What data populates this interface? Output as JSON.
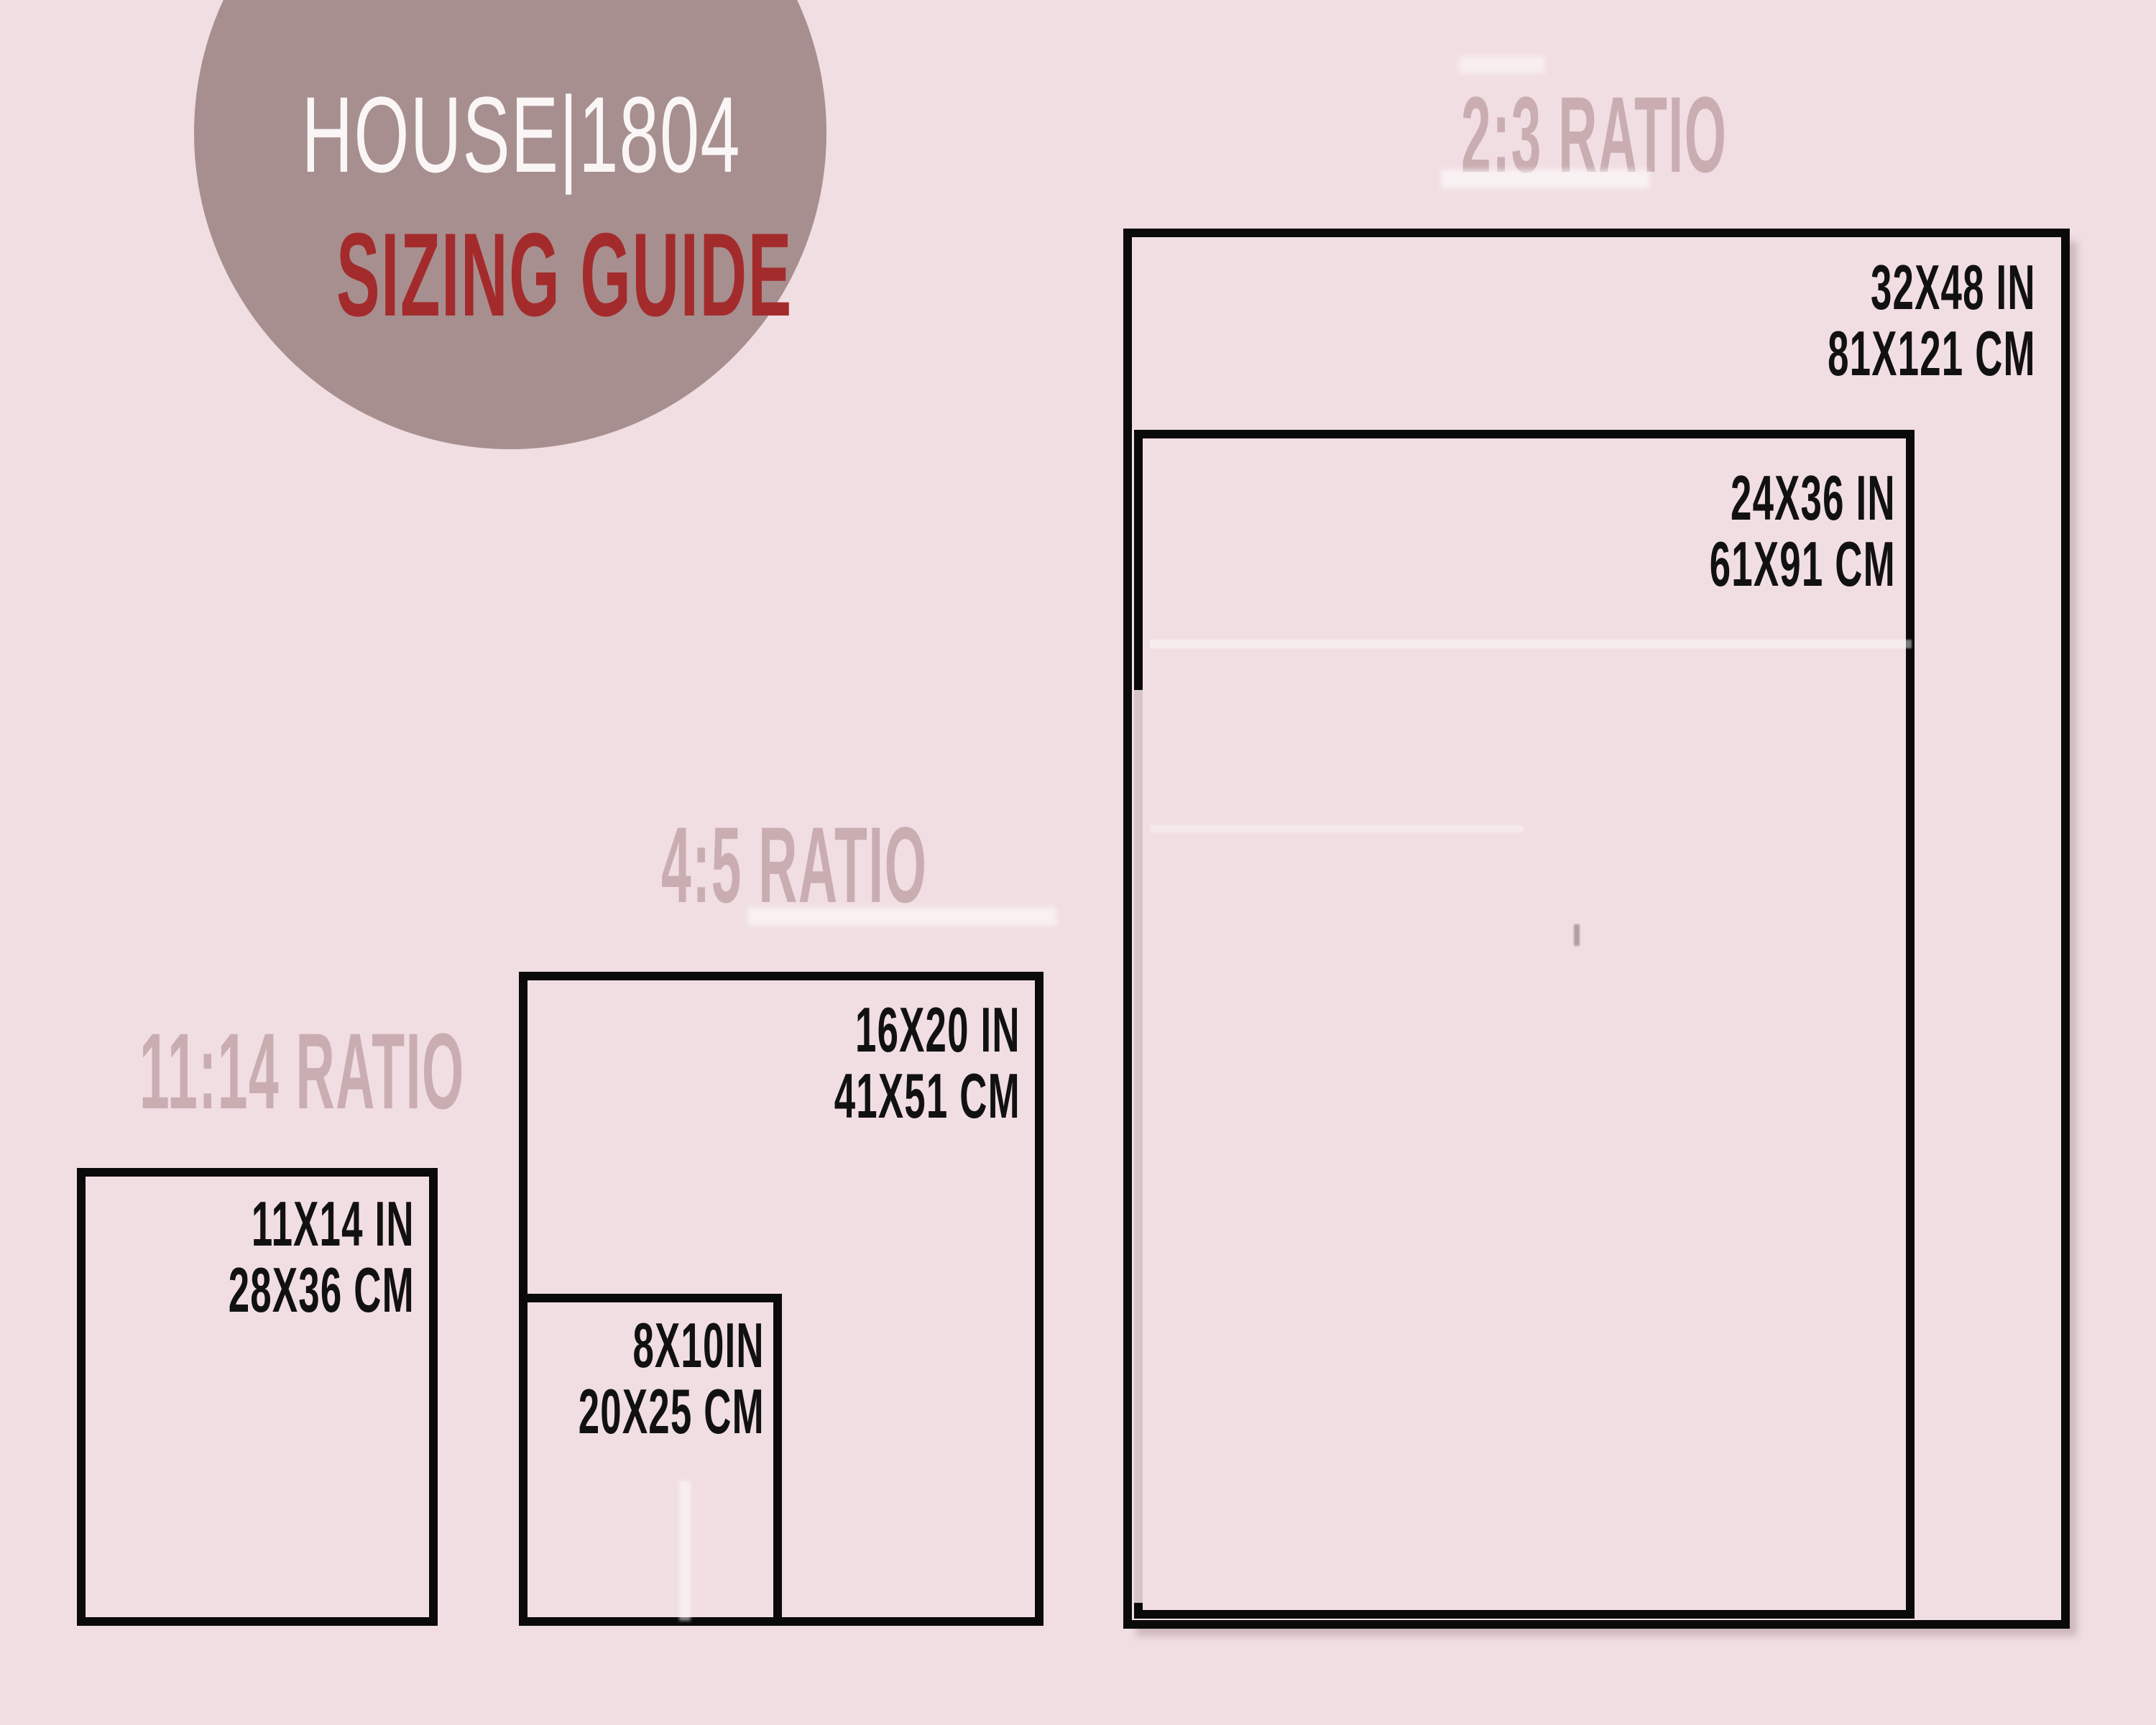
{
  "logo": {
    "brand": "HOUSE|1804",
    "tagline": "SIZING GUIDE"
  },
  "sections": [
    {
      "heading": "2:3 RATIO",
      "sizes": [
        {
          "inches": "32X48 IN",
          "cm": "81X121 CM"
        },
        {
          "inches": "24X36 IN",
          "cm": "61X91 CM"
        }
      ]
    },
    {
      "heading": "4:5 RATIO",
      "sizes": [
        {
          "inches": "16X20 IN",
          "cm": "41X51 CM"
        },
        {
          "inches": "8X10IN",
          "cm": "20X25 CM"
        }
      ]
    },
    {
      "heading": "11:14 RATIO",
      "sizes": [
        {
          "inches": "11X14 IN",
          "cm": "28X36 CM"
        }
      ]
    }
  ],
  "colors": {
    "background": "#f1dee2",
    "heading": "#c9adb1",
    "circle": "#a78f8f",
    "brand_text": "#fbf6f6",
    "tagline_red": "#a42b2c",
    "line_black": "#0b0a0a"
  }
}
